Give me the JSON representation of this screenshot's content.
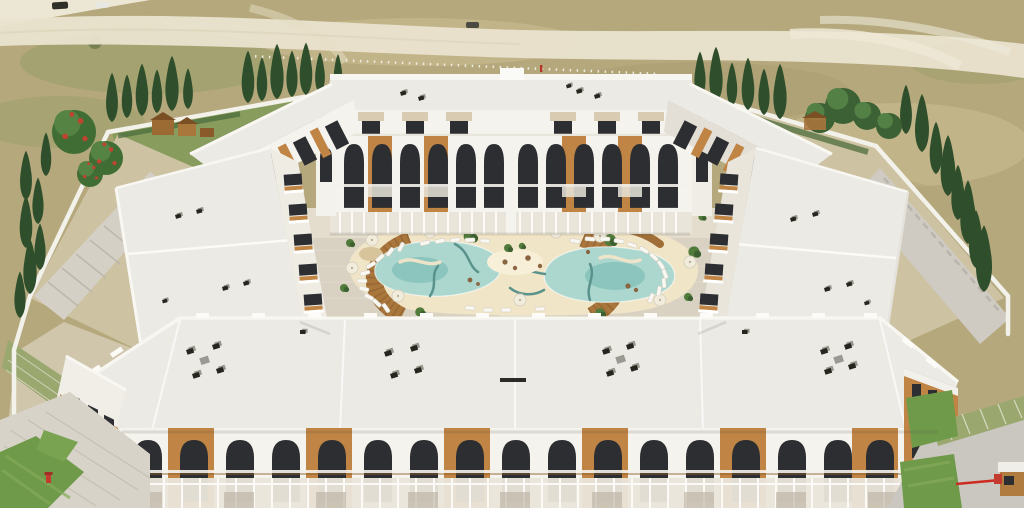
{
  "scene": {
    "description_name": "aerial-3d-render-residential-complex",
    "complex": {
      "buildings": "closed courtyard ring of white 3-storey apartment blocks",
      "style": "white Mediterranean facades with arched windows and wood-slat panels",
      "roofs": "flat white roofs with small dark vents and AC units",
      "courtyard": "lagoon-style pool with sandy beach, wooden deck arcs, sun loungers and umbrellas",
      "pool_count": 1,
      "lounger_count": 31,
      "umbrella_count": 9,
      "playground_count": 2,
      "entrance_booth_count": 1,
      "barrier": "red entrance barrier at bottom-right gate"
    },
    "surroundings": {
      "ground": "dry tan grassland with light dirt roads across the top",
      "perimeter": "white boundary wall lined with cypress trees",
      "lawns": "green lawn patches near bottom entrances",
      "vehicles": "three small vehicles on the far road"
    }
  },
  "palette": {
    "field": "#b5a87c",
    "field_light": "#cdc096",
    "field_olive": "#939c66",
    "road": "#eae3cf",
    "wall": "#f2f1ea",
    "roof": "#ebeae5",
    "roof_shade": "#d9d7d1",
    "facade": "#f5f3ed",
    "facade_shade": "#e3dfd6",
    "wood": "#c08445",
    "wood_dark": "#8f5f2c",
    "glass": "#2c2e31",
    "paving": "#d9d2c3",
    "terrace": "#e4ddcd",
    "sand": "#f1e5c8",
    "sand_light": "#f8efd9",
    "water": "#abd7cf",
    "water_deep": "#84c0b8",
    "channel": "#5a928c",
    "deck": "#a9763c",
    "deck_dark": "#7e5527",
    "lounger": "#f8f7f2",
    "lawn": "#6f9a4a",
    "lawn_light": "#85ab57",
    "paver_green": "#9aa870",
    "cypress": "#2f4f2c",
    "cypress_light": "#40653a",
    "tree": "#3c6134",
    "tree_light": "#538044",
    "red": "#c23b2e",
    "booth_wood": "#b07c3f",
    "path_gray": "#cfcbc3",
    "hedge": "#4c6d3c"
  }
}
